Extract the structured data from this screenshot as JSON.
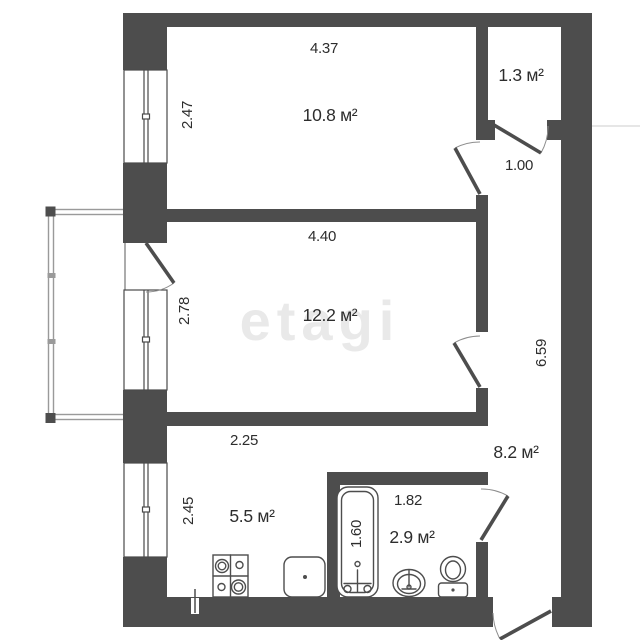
{
  "watermark": "etagi",
  "colors": {
    "wall": "#4d4d4d",
    "line": "#4a4a4a",
    "text": "#2d2d2d",
    "watermark": "#e9e9e9"
  },
  "rooms": {
    "room1": {
      "area": "10.8 м²"
    },
    "room2": {
      "area": "12.2 м²"
    },
    "kitchen": {
      "area": "5.5 м²"
    },
    "bathroom": {
      "area": "2.9 м²"
    },
    "hallway": {
      "area": "8.2 м²"
    },
    "closet": {
      "area": "1.3 м²"
    }
  },
  "dimensions": {
    "room1_width": "4.37",
    "room1_height": "2.47",
    "room2_width": "4.40",
    "room2_height": "2.78",
    "kitchen_width": "2.25",
    "kitchen_height": "2.45",
    "bathroom_width": "1.82",
    "bathtub_length": "1.60",
    "hallway_width": "1.00",
    "hallway_height": "6.59"
  },
  "fixtures": [
    "stove",
    "kitchen-sink",
    "bathtub",
    "washbasin",
    "toilet"
  ]
}
